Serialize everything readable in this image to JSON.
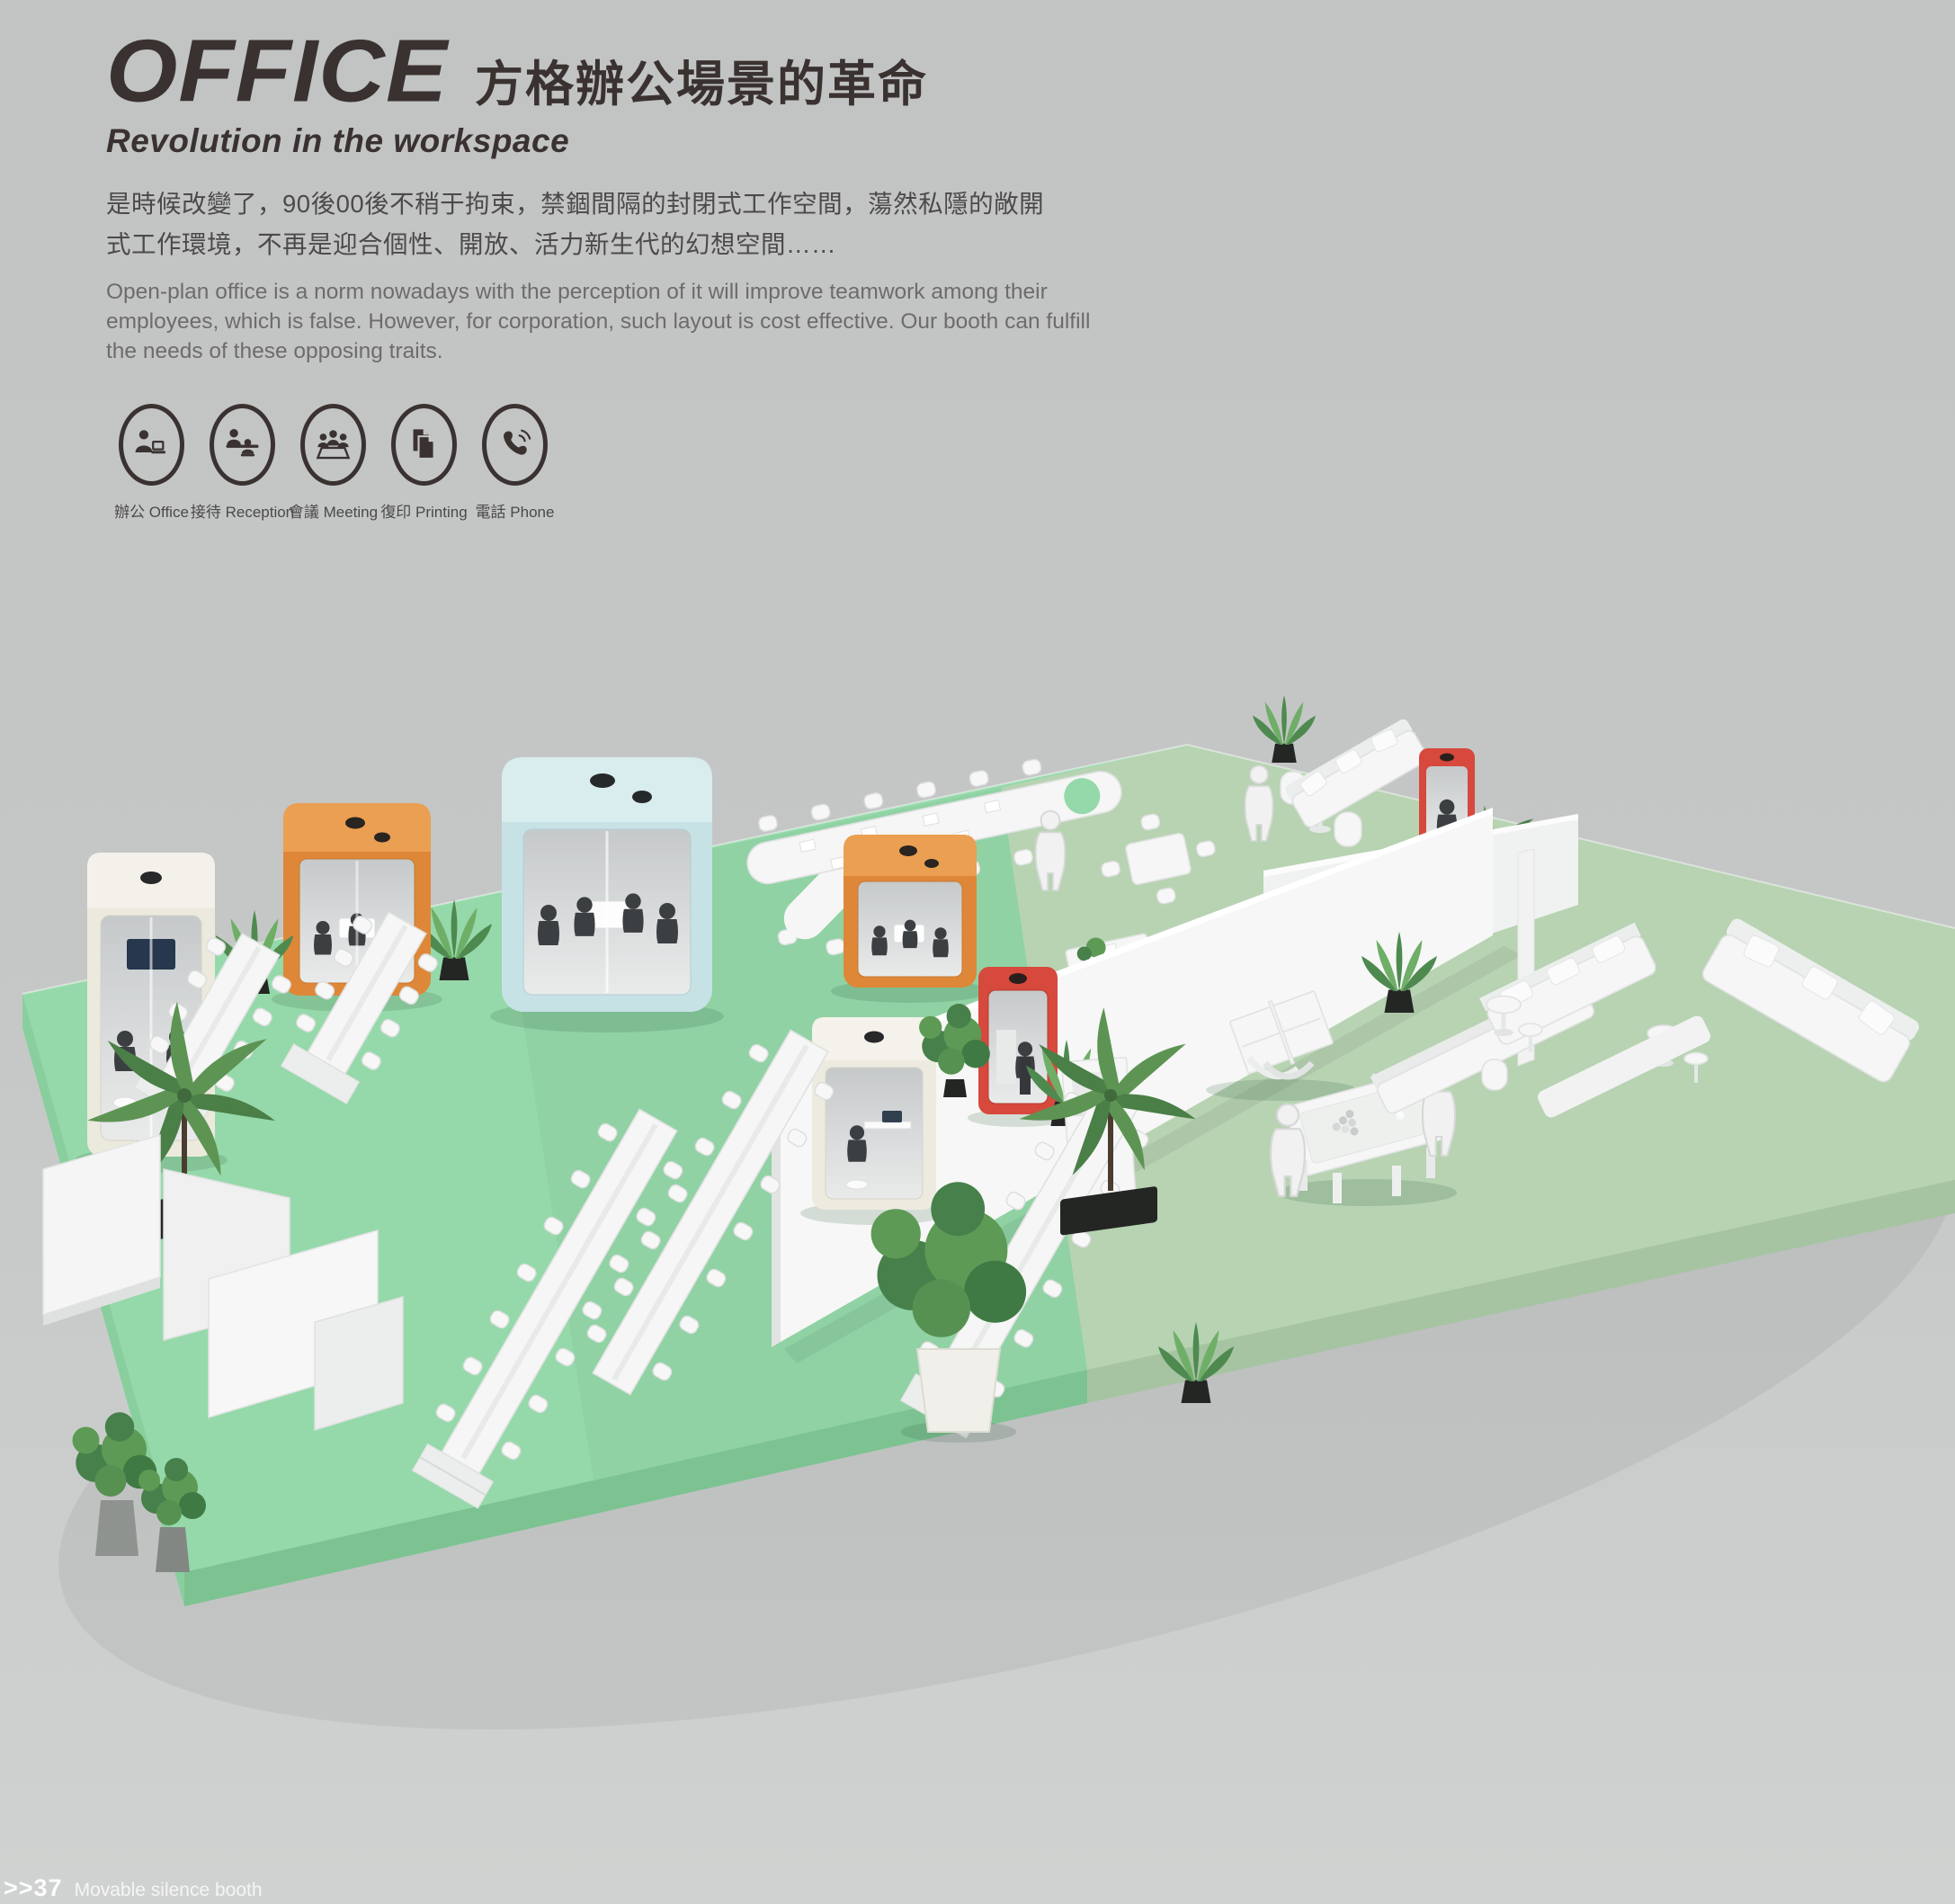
{
  "page": {
    "title_en": "OFFICE",
    "title_zh": "方格辦公場景的革命",
    "subtitle": "Revolution in the workspace",
    "paragraph_zh": "是時候改變了，90後00後不稍于拘束，禁錮間隔的封閉式工作空間，蕩然私隱的敞開式工作環境，不再是迎合個性、開放、活力新生代的幻想空間……",
    "paragraph_en": "Open-plan office is a norm nowadays with the perception of it will improve teamwork among their employees, which is false. However, for corporation, such layout is cost effective. Our booth can fulfill the needs of these opposing traits.",
    "features": [
      {
        "icon": "office-person-laptop-icon",
        "label": "辦公 Office"
      },
      {
        "icon": "reception-desk-icon",
        "label": "接待 Reception"
      },
      {
        "icon": "meeting-table-icon",
        "label": "會議 Meeting"
      },
      {
        "icon": "printing-documents-icon",
        "label": "復印 Printing"
      },
      {
        "icon": "phone-handset-icon",
        "label": "電話 Phone"
      }
    ],
    "footer": {
      "index": ">>37",
      "caption": "Movable silence booth"
    }
  },
  "scene": {
    "description": "Isometric 3D render of an open-plan exhibition office floor with movable silence booths, desk rows, lounge, ping-pong and pool tables",
    "background_color": "#c5c7c7",
    "floor_colors": {
      "mint": "#95d9aa",
      "sage": "#b7d3b2",
      "front_edge": "#7cc391"
    },
    "booths": [
      {
        "name": "cream-duo-booth",
        "color": "#ece9dd"
      },
      {
        "name": "orange-meeting-booth-left",
        "color": "#df8738"
      },
      {
        "name": "blue-meeting-booth",
        "color": "#c7e2e5"
      },
      {
        "name": "orange-meeting-booth-center",
        "color": "#df8738"
      },
      {
        "name": "red-phone-booth-center",
        "color": "#d6493c"
      },
      {
        "name": "white-solo-booth",
        "color": "#edebe0"
      },
      {
        "name": "red-phone-booth-top",
        "color": "#d6493c"
      }
    ]
  }
}
